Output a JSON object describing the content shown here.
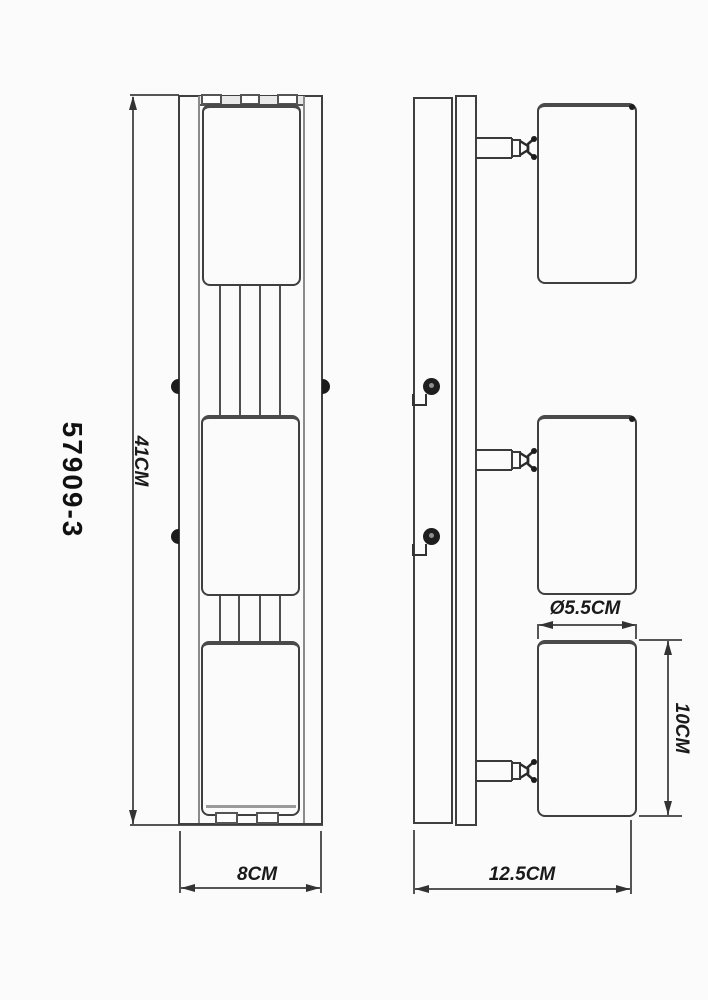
{
  "drawing": {
    "model": "57909-3",
    "dimensions": {
      "height": "41CM",
      "width": "8CM",
      "depth": "12.5CM",
      "head_diameter": "Ø5.5CM",
      "head_height": "10CM"
    },
    "colors": {
      "line": "#3f3f3f",
      "text": "#1a1a1a",
      "background": "#fbfbfb"
    }
  }
}
